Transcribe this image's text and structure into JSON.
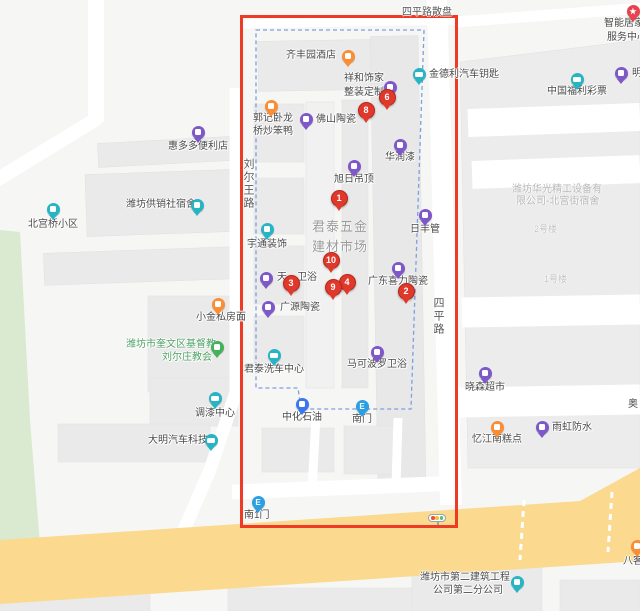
{
  "colors": {
    "marker_red": "#e0392b",
    "selection_box": "#ee3b26",
    "boundary_dash": "#7d9fe2",
    "road_yellow": "#fbd98f",
    "green_area": "#d9ead0",
    "building": "#eaeaea",
    "purple": "#7e57c8",
    "teal": "#27b5c5",
    "orange": "#fb8d34",
    "green_icon": "#46b05a",
    "blue": "#3a76f0",
    "entrance_blue": "#2b9fe3",
    "star_red": "#e8414f"
  },
  "map": {
    "road_labels": [
      {
        "id": "siping-road-sanpan",
        "text": "四平路散盘",
        "pos": [
          402,
          3
        ],
        "orient": "h",
        "size": 10
      },
      {
        "id": "liuerwang-road",
        "text": "刘尔王路",
        "pos": [
          240,
          158
        ],
        "orient": "v",
        "size": 11
      },
      {
        "id": "siping-road",
        "text": "四平路",
        "pos": [
          430,
          297
        ],
        "orient": "v",
        "size": 11
      }
    ],
    "area_labels": [
      {
        "id": "juntai-market-line1",
        "text": "君泰五金",
        "pos": [
          312,
          216
        ],
        "size": 13,
        "ls": 1,
        "color": "#9b9b9b"
      },
      {
        "id": "juntai-market-line2",
        "text": "建材市场",
        "pos": [
          312,
          236
        ],
        "size": 13,
        "ls": 1,
        "color": "#9b9b9b"
      },
      {
        "id": "huaguang-line1",
        "text": "潍坊华光精工设备有",
        "pos": [
          512,
          180
        ],
        "size": 10,
        "ls": 0,
        "color": "#b9b9b9"
      },
      {
        "id": "huaguang-line2",
        "text": "限公司-北宫街宿舍",
        "pos": [
          516,
          192
        ],
        "size": 10,
        "ls": 0,
        "color": "#b9b9b9"
      },
      {
        "id": "building-no2",
        "text": "2号楼",
        "pos": [
          534,
          222
        ],
        "size": 9,
        "ls": 0,
        "color": "#c5c5c5"
      },
      {
        "id": "building-no1",
        "text": "1号楼",
        "pos": [
          544,
          272
        ],
        "size": 9,
        "ls": 0,
        "color": "#c5c5c5"
      }
    ],
    "pois": [
      {
        "id": "qifengyuan-hotel",
        "lines": [
          "齐丰园酒店"
        ],
        "lpos": [
          [
            286,
            50
          ]
        ],
        "icon": "bag",
        "color": "orange",
        "ipos": [
          348,
          56
        ]
      },
      {
        "id": "xianghe-shijia",
        "lines": [
          "祥和饰家",
          "整装定制"
        ],
        "lpos": [
          [
            344,
            73
          ],
          [
            344,
            87
          ]
        ],
        "icon": "bag",
        "color": "purple",
        "ipos": [
          390,
          87
        ]
      },
      {
        "id": "jindeli-car-key",
        "lines": [
          "金德利汽车钥匙"
        ],
        "lpos": [
          [
            429,
            69
          ]
        ],
        "icon": "car",
        "color": "teal",
        "ipos": [
          419,
          74
        ]
      },
      {
        "id": "china-welfare-lottery",
        "lines": [
          "中国福利彩票"
        ],
        "lpos": [
          [
            547,
            86
          ]
        ],
        "icon": "car",
        "color": "teal",
        "ipos": [
          577,
          79
        ]
      },
      {
        "id": "ming-partial",
        "lines": [
          "明"
        ],
        "lpos": [
          [
            632,
            68
          ]
        ],
        "icon": "bag",
        "color": "purple",
        "ipos": [
          621,
          73
        ]
      },
      {
        "id": "zhineng-jujia",
        "lines": [
          "智能居家",
          "服务中心"
        ],
        "lpos": [
          [
            604,
            18
          ],
          [
            607,
            32
          ]
        ],
        "icon": "star",
        "color": "star_red",
        "ipos": [
          633,
          11
        ]
      },
      {
        "id": "guoji-wolong-duck",
        "lines": [
          "郭记卧龙",
          "桥炒笨鸭"
        ],
        "lpos": [
          [
            253,
            113
          ],
          [
            253,
            126
          ]
        ],
        "icon": "bag",
        "color": "orange",
        "ipos": [
          271,
          106
        ]
      },
      {
        "id": "foshan-taoci",
        "lines": [
          "佛山陶瓷"
        ],
        "lpos": [
          [
            316,
            114
          ]
        ],
        "icon": "bag",
        "color": "purple",
        "ipos": [
          306,
          119
        ]
      },
      {
        "id": "huiduoduo-store",
        "lines": [
          "惠多多便利店"
        ],
        "lpos": [
          [
            168,
            141
          ]
        ],
        "icon": "bag",
        "color": "purple",
        "ipos": [
          198,
          132
        ]
      },
      {
        "id": "huarun-paint",
        "lines": [
          "华润漆"
        ],
        "lpos": [
          [
            385,
            152
          ]
        ],
        "icon": "bag",
        "color": "purple",
        "ipos": [
          400,
          145
        ]
      },
      {
        "id": "xuri-diaoding",
        "lines": [
          "旭日吊顶"
        ],
        "lpos": [
          [
            334,
            174
          ]
        ],
        "icon": "bag",
        "color": "purple",
        "ipos": [
          354,
          166
        ]
      },
      {
        "id": "gongxiaoshe-sushe",
        "lines": [
          "潍坊供销社宿舍"
        ],
        "lpos": [
          [
            126,
            199
          ]
        ],
        "icon": "bag",
        "color": "teal",
        "ipos": [
          197,
          205
        ]
      },
      {
        "id": "beigongqiao-xiaoqu",
        "lines": [
          "北宫桥小区"
        ],
        "lpos": [
          [
            28,
            219
          ]
        ],
        "icon": "bag",
        "color": "teal",
        "ipos": [
          53,
          209
        ]
      },
      {
        "id": "yutong-zhuangshi",
        "lines": [
          "宇通装饰"
        ],
        "lpos": [
          [
            247,
            239
          ]
        ],
        "icon": "bag",
        "color": "teal",
        "ipos": [
          267,
          229
        ]
      },
      {
        "id": "rifeng-guan",
        "lines": [
          "日丰管"
        ],
        "lpos": [
          [
            410,
            224
          ]
        ],
        "icon": "bag",
        "color": "purple",
        "ipos": [
          425,
          215
        ]
      },
      {
        "id": "guangdong-xili-taoci",
        "lines": [
          "广东喜力陶瓷"
        ],
        "lpos": [
          [
            368,
            276
          ]
        ],
        "icon": "bag",
        "color": "purple",
        "ipos": [
          398,
          268
        ]
      },
      {
        "id": "tian-weiyu",
        "lines": [
          "天",
          "卫浴"
        ],
        "lpos": [
          [
            277,
            272
          ],
          [
            297,
            272
          ]
        ],
        "icon": "bag",
        "color": "purple",
        "ipos": [
          266,
          278
        ]
      },
      {
        "id": "guangyuan-taoci",
        "lines": [
          "广源陶瓷"
        ],
        "lpos": [
          [
            280,
            302
          ]
        ],
        "icon": "bag",
        "color": "purple",
        "ipos": [
          268,
          307
        ]
      },
      {
        "id": "xiaojin-sifangmian",
        "lines": [
          "小金私房面"
        ],
        "lpos": [
          [
            196,
            312
          ]
        ],
        "icon": "bag",
        "color": "orange",
        "ipos": [
          218,
          304
        ]
      },
      {
        "id": "liuerzhuang-church",
        "lines": [
          "潍坊市奎文区基督教",
          "刘尔庄教会"
        ],
        "lpos": [
          [
            126,
            339
          ],
          [
            162,
            352
          ]
        ],
        "icon": "bag",
        "color": "green_icon",
        "ipos": [
          217,
          347
        ],
        "lcolor": "#4ea164"
      },
      {
        "id": "makeboluo-weiyu",
        "lines": [
          "马可波罗卫浴"
        ],
        "lpos": [
          [
            347,
            359
          ]
        ],
        "icon": "bag",
        "color": "purple",
        "ipos": [
          377,
          352
        ]
      },
      {
        "id": "juntai-xiche",
        "lines": [
          "君泰洗车中心"
        ],
        "lpos": [
          [
            244,
            364
          ]
        ],
        "icon": "car",
        "color": "teal",
        "ipos": [
          274,
          355
        ]
      },
      {
        "id": "xiaosen-chaoshi",
        "lines": [
          "晓森超市"
        ],
        "lpos": [
          [
            465,
            382
          ]
        ],
        "icon": "bag",
        "color": "purple",
        "ipos": [
          485,
          373
        ]
      },
      {
        "id": "tiaoqi-center",
        "lines": [
          "调漆中心"
        ],
        "lpos": [
          [
            195,
            408
          ]
        ],
        "icon": "car",
        "color": "teal",
        "ipos": [
          215,
          398
        ]
      },
      {
        "id": "zhonghua-shiyou",
        "lines": [
          "中化石油"
        ],
        "lpos": [
          [
            282,
            412
          ]
        ],
        "icon": "bag",
        "color": "blue",
        "ipos": [
          302,
          404
        ]
      },
      {
        "id": "nanmen-entrance",
        "lines": [
          "南门"
        ],
        "lpos": [
          [
            352,
            414
          ]
        ],
        "icon": "entrance",
        "color": "entrance_blue",
        "ipos": [
          362,
          406
        ]
      },
      {
        "id": "yijiangnan-gaodian",
        "lines": [
          "忆江南糕点"
        ],
        "lpos": [
          [
            472,
            434
          ]
        ],
        "icon": "bag",
        "color": "orange",
        "ipos": [
          497,
          427
        ]
      },
      {
        "id": "yuhong-fangshui",
        "lines": [
          "雨虹防水"
        ],
        "lpos": [
          [
            552,
            422
          ]
        ],
        "icon": "bag",
        "color": "purple",
        "ipos": [
          542,
          427
        ]
      },
      {
        "id": "ao-partial",
        "lines": [
          "奥"
        ],
        "lpos": [
          [
            628,
            399
          ]
        ]
      },
      {
        "id": "daming-qiche",
        "lines": [
          "大明汽车科技"
        ],
        "lpos": [
          [
            148,
            435
          ]
        ],
        "icon": "car",
        "color": "teal",
        "ipos": [
          211,
          440
        ]
      },
      {
        "id": "nan1men-entrance",
        "lines": [
          "南1门"
        ],
        "lpos": [
          [
            244,
            510
          ]
        ],
        "icon": "entrance",
        "color": "entrance_blue",
        "ipos": [
          258,
          502
        ]
      },
      {
        "id": "bake-partial",
        "lines": [
          "八客"
        ],
        "lpos": [
          [
            623,
            556
          ]
        ],
        "icon": "bag",
        "color": "orange",
        "ipos": [
          637,
          546
        ]
      },
      {
        "id": "dierjianzhu-company",
        "lines": [
          "潍坊市第二建筑工程",
          "公司第二分公司"
        ],
        "lpos": [
          [
            420,
            572
          ],
          [
            433,
            585
          ]
        ],
        "icon": "bag",
        "color": "teal",
        "ipos": [
          517,
          582
        ]
      },
      {
        "id": "traffic-light",
        "lines": [],
        "lpos": [],
        "icon": "traffic",
        "ipos": [
          437,
          518
        ]
      }
    ],
    "markers": [
      {
        "n": "1",
        "pos": [
          339,
          198
        ]
      },
      {
        "n": "2",
        "pos": [
          406,
          291
        ]
      },
      {
        "n": "3",
        "pos": [
          291,
          283
        ]
      },
      {
        "n": "4",
        "pos": [
          347,
          282
        ]
      },
      {
        "n": "6",
        "pos": [
          387,
          97
        ]
      },
      {
        "n": "8",
        "pos": [
          366,
          110
        ]
      },
      {
        "n": "9",
        "pos": [
          333,
          287
        ]
      },
      {
        "n": "10",
        "pos": [
          331,
          260
        ]
      }
    ],
    "traffic_light_dots": [
      "#e8503a",
      "#f5c03c",
      "#58c06a"
    ]
  }
}
